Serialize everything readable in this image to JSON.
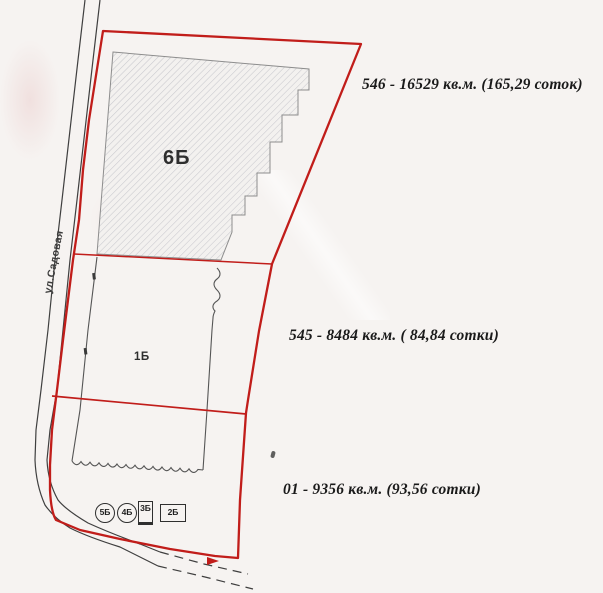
{
  "plan": {
    "street_label": "ул.Садовая",
    "zone_labels": {
      "z6b": "6Б",
      "z1b": "1Б"
    },
    "annotations": [
      {
        "id": "546",
        "text": "546 - 16529 кв.м. (165,29 соток)"
      },
      {
        "id": "545",
        "text": "545 - 8484 кв.м. ( 84,84 сотки)"
      },
      {
        "id": "01",
        "text": "01 - 9356 кв.м. (93,56 сотки)"
      }
    ],
    "markers": [
      {
        "shape": "circle",
        "label": "5Б"
      },
      {
        "shape": "circle",
        "label": "4Б"
      },
      {
        "shape": "rect",
        "label": "3Б"
      },
      {
        "shape": "rect",
        "label": "2Б"
      }
    ],
    "colors": {
      "boundary_red": "#c11d1a",
      "road_gray": "#3f3f3f",
      "thin_line": "#555555",
      "hatch_line": "#c9c9ce",
      "hatch_fill": "#f3f1ef",
      "paper": "#f6f3f1",
      "text_black": "#1a1a1a"
    }
  }
}
